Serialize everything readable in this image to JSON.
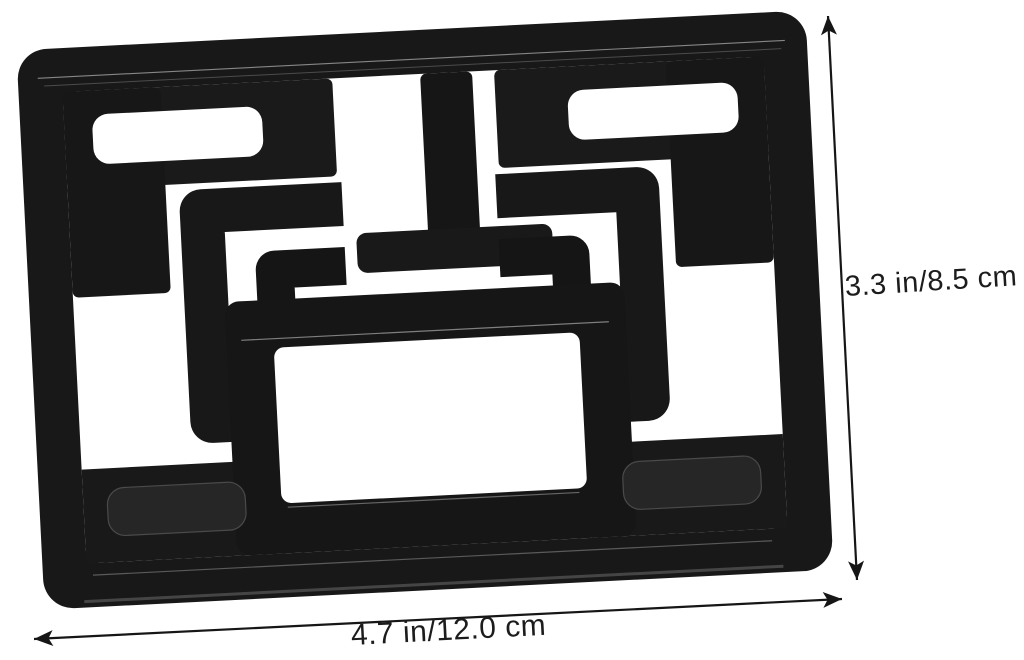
{
  "canvas": {
    "background_color": "#ffffff"
  },
  "product": {
    "description": "black foldable stand plate with maze cutouts",
    "body_color": "#181818",
    "dark_accent_color": "#141414",
    "seam_highlight_color": "#9a9a9a",
    "recess_slot_color": "#262626"
  },
  "dimensions": {
    "height_label": "3.3 in/8.5 cm",
    "width_label": "4.7 in/12.0 cm",
    "line_color": "#161616",
    "label_color": "#1c1c1c"
  }
}
